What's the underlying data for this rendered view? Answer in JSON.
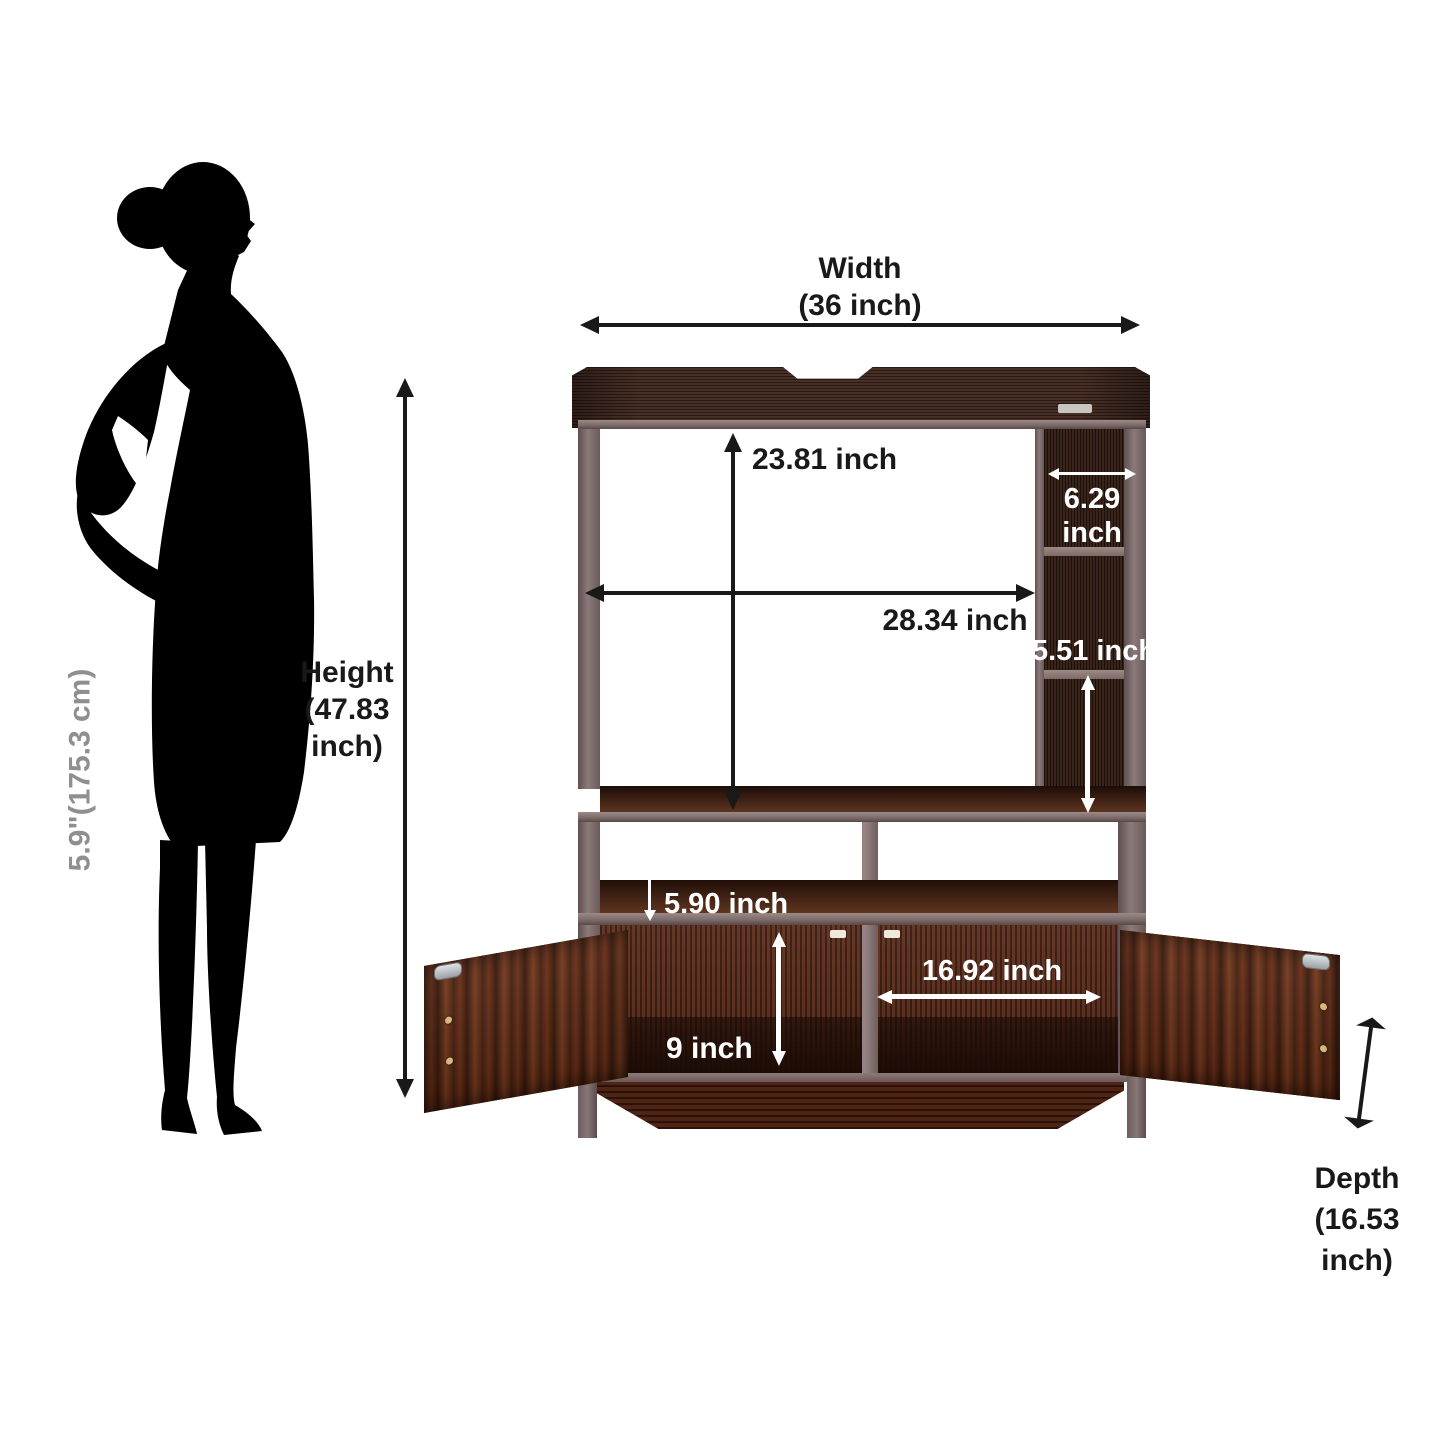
{
  "figure": {
    "scale_label": "5.9\"(175.3 cm)"
  },
  "labels": {
    "width": {
      "lines": [
        "Width",
        "(36 inch)"
      ]
    },
    "height": {
      "lines": [
        "Height",
        "(47.83",
        "inch)"
      ]
    },
    "depth": {
      "lines": [
        "Depth",
        "(16.53",
        "inch)"
      ]
    },
    "tv_opening_height": "23.81 inch",
    "tv_opening_width": "28.34 inch",
    "side_cubby_width": {
      "lines": [
        "6.29",
        "inch"
      ]
    },
    "side_cubby_height": "5.51 inch",
    "middle_shelf_height": "5.90 inch",
    "cabinet_opening_width": "16.92 inch",
    "cabinet_opening_height": "9 inch"
  },
  "colors": {
    "background": "#ffffff",
    "annotation_black": "#191919",
    "annotation_white": "#ffffff",
    "scale_label_gray": "#8f8f8f",
    "wood_crown": "#3a2620",
    "wood_column": "#2c1b15",
    "wood_interior": "#4e2315",
    "wood_door_mahogany": "#6b2f17",
    "frame_gray": "#7c6b6b",
    "silhouette": "#000000"
  }
}
